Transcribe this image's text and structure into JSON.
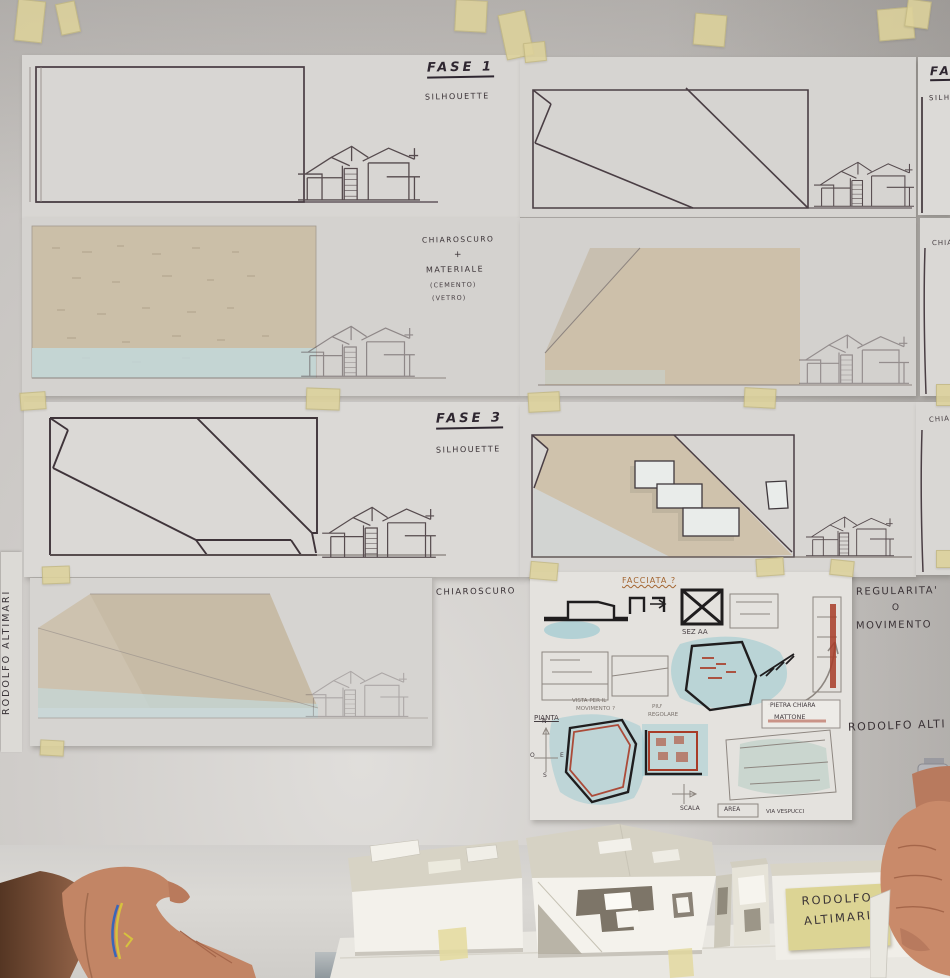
{
  "labels": {
    "fase1": "FASE 1",
    "fase1_sub": "SILHOUETTE",
    "fase2_cut": "FA",
    "fase2_sub_cut": "SILH",
    "mat_l1": "CHIAROSCURO",
    "mat_l2": "+",
    "mat_l3": "MATERIALE",
    "mat_l4": "(CEMENTO)",
    "mat_l5": "(VETRO)",
    "row2_cut": "CHIA",
    "fase3": "FASE 3",
    "fase3_sub": "SILHOUETTE",
    "row3_cut": "CHIAR",
    "row4_left": "CHIAROSCURO",
    "reg_l1": "REGULARITA'",
    "reg_l2": "O",
    "reg_l3": "MOVIMENTO",
    "author_cut": "RODOLFO  ALTI",
    "author_vertical": "RODOLFO   ALTIMARI"
  },
  "sketch": {
    "facciata": "FACCIATA ?",
    "sez": "SEZ AA",
    "vista_l1": "VISTA PER IL",
    "vista_l2": "MOVIMENTO ?",
    "piu_l1": "PIU'",
    "piu_l2": "REGOLARE",
    "pianta": "PIANTA",
    "mat_l1": "PIETRA CHIARA",
    "mat_l2": "MATTONE",
    "scala": "SCALA",
    "area": "AREA",
    "via": "VIA VESPUCCI",
    "n": "N",
    "s": "S",
    "e": "E",
    "o": "O"
  },
  "model_note": {
    "l1": "RODOLFO",
    "l2": "ALTIMARI"
  },
  "colors": {
    "tape": "#ddd29b",
    "tan_wash": "#cdc0aa",
    "blue_wash": "#9ecbd1",
    "ink": "#4a3e44",
    "note_yellow": "#dcd494",
    "skin": "#c28565"
  }
}
